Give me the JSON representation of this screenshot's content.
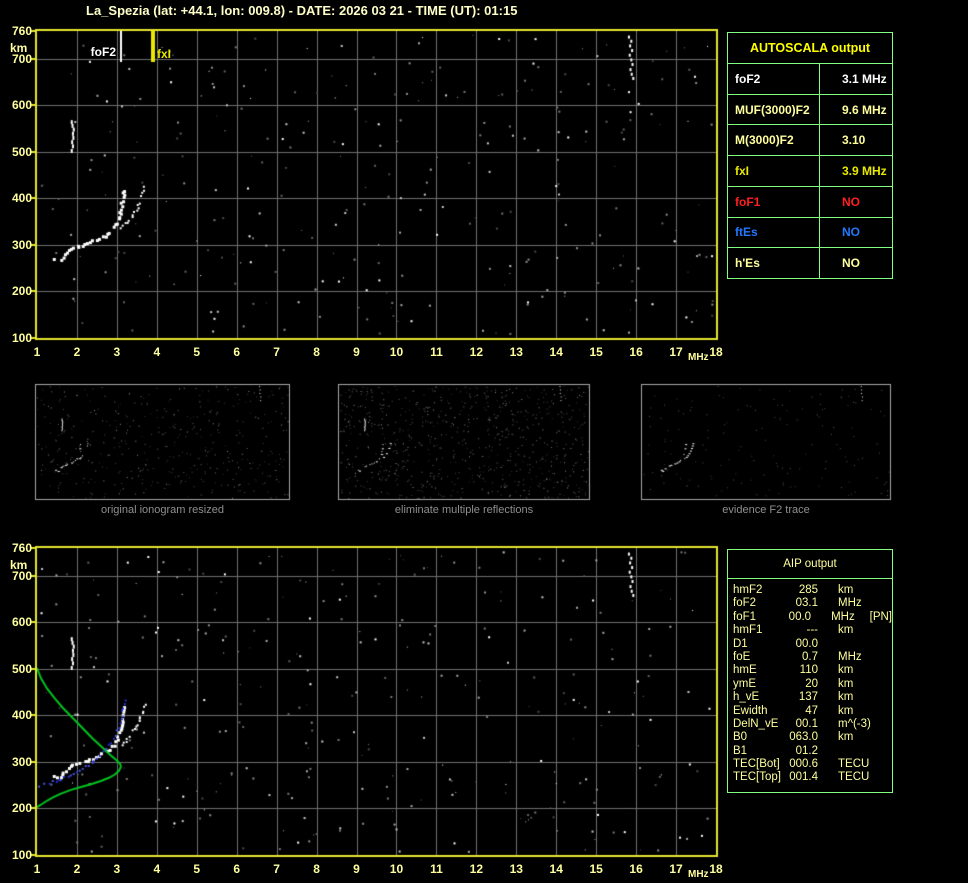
{
  "title": "La_Spezia (lat: +44.1, lon: 009.8) - DATE: 2026 03 21 - TIME (UT): 01:15",
  "colors": {
    "background": "#000000",
    "title_text": "#ffffc8",
    "axis_text": "#ffff9e",
    "plot_border": "#e6e62e",
    "gridline": "#6f6f6f",
    "table_border": "#80ff80",
    "autoscala_header": "#ffff00",
    "green_profile": "#00c31f",
    "blue_fitted_trace": "#2530d8",
    "echo_white": "#ffffff",
    "thumb_border": "#a8a8a8",
    "caption_text": "#8f8f8f"
  },
  "plot_markers": {
    "foF2_label": "foF2",
    "fxI_label": "fxI"
  },
  "autoscala_table": {
    "header": "AUTOSCALA output",
    "rows": [
      {
        "label": "foF2",
        "value": "3.1 MHz",
        "color": "#ffffff"
      },
      {
        "label": "MUF(3000)F2",
        "value": "9.6 MHz",
        "color": "#ffff9e"
      },
      {
        "label": "M(3000)F2",
        "value": "3.10",
        "color": "#ffff9e"
      },
      {
        "label": "fxI",
        "value": "3.9 MHz",
        "color": "#e8e800"
      },
      {
        "label": "foF1",
        "value": "NO",
        "color": "#ff2020"
      },
      {
        "label": "ftEs",
        "value": "NO",
        "color": "#2277ff"
      },
      {
        "label": "h'Es",
        "value": "NO",
        "color": "#ffff9e"
      }
    ]
  },
  "aip_table": {
    "header": "AIP output",
    "rows": [
      {
        "label": "hmF2",
        "value": "285",
        "unit": "km",
        "extra": ""
      },
      {
        "label": "foF2",
        "value": "03.1",
        "unit": "MHz",
        "extra": ""
      },
      {
        "label": "foF1",
        "value": "00.0",
        "unit": "MHz",
        "extra": "[PN]"
      },
      {
        "label": "hmF1",
        "value": "---",
        "unit": "km",
        "extra": ""
      },
      {
        "label": "D1",
        "value": "00.0",
        "unit": "",
        "extra": ""
      },
      {
        "label": "foE",
        "value": "0.7",
        "unit": "MHz",
        "extra": ""
      },
      {
        "label": "hmE",
        "value": "110",
        "unit": "km",
        "extra": ""
      },
      {
        "label": "ymE",
        "value": "20",
        "unit": "km",
        "extra": ""
      },
      {
        "label": "h_vE",
        "value": "137",
        "unit": "km",
        "extra": ""
      },
      {
        "label": "Ewidth",
        "value": "47",
        "unit": "km",
        "extra": ""
      },
      {
        "label": "DelN_vE",
        "value": "00.1",
        "unit": "m^(-3)",
        "extra": ""
      },
      {
        "label": "B0",
        "value": "063.0",
        "unit": "km",
        "extra": ""
      },
      {
        "label": "B1",
        "value": "01.2",
        "unit": "",
        "extra": ""
      },
      {
        "label": "TEC[Bot]",
        "value": "000.6",
        "unit": "TECU",
        "extra": ""
      },
      {
        "label": "TEC[Top]",
        "value": "001.4",
        "unit": "TECU",
        "extra": ""
      }
    ]
  },
  "thumbnails": [
    {
      "caption": "original ionogram resized"
    },
    {
      "caption": "eliminate multiple reflections"
    },
    {
      "caption": "evidence F2 trace"
    }
  ],
  "chart_data": [
    {
      "id": "main-ionogram",
      "type": "scatter",
      "title": "",
      "xlabel": "MHz",
      "ylabel": "km",
      "xlim": [
        1,
        18
      ],
      "ylim": [
        100,
        760
      ],
      "grid": true,
      "x_ticks": [
        1,
        2,
        3,
        4,
        5,
        6,
        7,
        8,
        9,
        10,
        11,
        12,
        13,
        14,
        15,
        16,
        17,
        18
      ],
      "y_ticks": [
        760,
        700,
        600,
        500,
        400,
        300,
        200,
        100
      ],
      "markers": {
        "foF2_MHz": 3.1,
        "fxI_MHz": 3.9
      },
      "series": [
        {
          "name": "F2 trace O-mode",
          "color": "#ffffff",
          "points": [
            [
              1.42,
              272
            ],
            [
              1.5,
              267
            ],
            [
              1.6,
              265
            ],
            [
              1.7,
              280
            ],
            [
              1.8,
              287
            ],
            [
              1.9,
              292
            ],
            [
              2.0,
              296
            ],
            [
              2.12,
              300
            ],
            [
              2.25,
              304
            ],
            [
              2.4,
              308
            ],
            [
              2.55,
              313
            ],
            [
              2.7,
              320
            ],
            [
              2.82,
              328
            ],
            [
              2.92,
              337
            ],
            [
              3.0,
              348
            ],
            [
              3.06,
              362
            ],
            [
              3.1,
              378
            ],
            [
              3.13,
              394
            ],
            [
              3.16,
              408
            ],
            [
              3.18,
              418
            ]
          ]
        },
        {
          "name": "F2 trace X-mode",
          "color": "#ffffff",
          "points": [
            [
              3.12,
              338
            ],
            [
              3.22,
              345
            ],
            [
              3.32,
              354
            ],
            [
              3.42,
              366
            ],
            [
              3.52,
              381
            ],
            [
              3.6,
              396
            ],
            [
              3.66,
              410
            ],
            [
              3.7,
              423
            ]
          ]
        },
        {
          "name": "second order echo",
          "color": "#ffffff",
          "points": [
            [
              1.87,
              502
            ],
            [
              1.9,
              512
            ],
            [
              1.88,
              521
            ],
            [
              1.91,
              530
            ],
            [
              1.9,
              539
            ],
            [
              1.92,
              548
            ],
            [
              1.89,
              556
            ],
            [
              1.87,
              564
            ]
          ]
        },
        {
          "name": "echo cluster 16 MHz",
          "color": "#ffffff",
          "points": [
            [
              15.82,
              748
            ],
            [
              15.88,
              739
            ],
            [
              15.85,
              729
            ],
            [
              15.9,
              719
            ],
            [
              15.84,
              709
            ],
            [
              15.88,
              699
            ],
            [
              15.91,
              689
            ],
            [
              15.86,
              678
            ],
            [
              15.89,
              668
            ],
            [
              15.93,
              659
            ]
          ]
        }
      ]
    },
    {
      "id": "aip-ionogram",
      "type": "scatter",
      "title": "",
      "xlabel": "MHz",
      "ylabel": "km",
      "xlim": [
        1,
        18
      ],
      "ylim": [
        100,
        760
      ],
      "grid": true,
      "x_ticks": [
        1,
        2,
        3,
        4,
        5,
        6,
        7,
        8,
        9,
        10,
        11,
        12,
        13,
        14,
        15,
        16,
        17,
        18
      ],
      "y_ticks": [
        760,
        700,
        600,
        500,
        400,
        300,
        200,
        100
      ],
      "series": [
        {
          "name": "electron density profile",
          "color": "#00c31f",
          "points": [
            [
              1.0,
              502
            ],
            [
              1.1,
              480
            ],
            [
              1.25,
              458
            ],
            [
              1.45,
              436
            ],
            [
              1.65,
              416
            ],
            [
              1.9,
              394
            ],
            [
              2.15,
              372
            ],
            [
              2.4,
              350
            ],
            [
              2.65,
              330
            ],
            [
              2.85,
              314
            ],
            [
              3.0,
              303
            ],
            [
              3.08,
              296
            ],
            [
              3.1,
              290
            ],
            [
              3.05,
              281
            ],
            [
              2.95,
              273
            ],
            [
              2.8,
              266
            ],
            [
              2.6,
              259
            ],
            [
              2.35,
              252
            ],
            [
              2.1,
              246
            ],
            [
              1.85,
              240
            ],
            [
              1.6,
              232
            ],
            [
              1.4,
              224
            ],
            [
              1.22,
              215
            ],
            [
              1.08,
              207
            ],
            [
              1.0,
              203
            ]
          ]
        },
        {
          "name": "fitted F2 trace",
          "color": "#2530d8",
          "points": [
            [
              1.05,
              247
            ],
            [
              1.18,
              251
            ],
            [
              1.32,
              255
            ],
            [
              1.47,
              259
            ],
            [
              1.62,
              263
            ],
            [
              1.77,
              268
            ],
            [
              1.92,
              274
            ],
            [
              2.07,
              281
            ],
            [
              2.22,
              289
            ],
            [
              2.37,
              298
            ],
            [
              2.52,
              309
            ],
            [
              2.67,
              321
            ],
            [
              2.8,
              335
            ],
            [
              2.9,
              350
            ],
            [
              3.0,
              366
            ],
            [
              3.07,
              383
            ],
            [
              3.13,
              400
            ],
            [
              3.18,
              417
            ],
            [
              3.22,
              432
            ]
          ]
        }
      ]
    },
    {
      "id": "processing-thumbnails",
      "type": "scatter",
      "xlim": [
        0,
        18
      ],
      "ylim": [
        100,
        760
      ],
      "panels": [
        "original ionogram resized",
        "eliminate multiple reflections",
        "evidence F2 trace"
      ]
    }
  ],
  "noise": {
    "seed": 9,
    "main_count": 300,
    "thumb_counts": [
      420,
      760,
      150
    ]
  }
}
